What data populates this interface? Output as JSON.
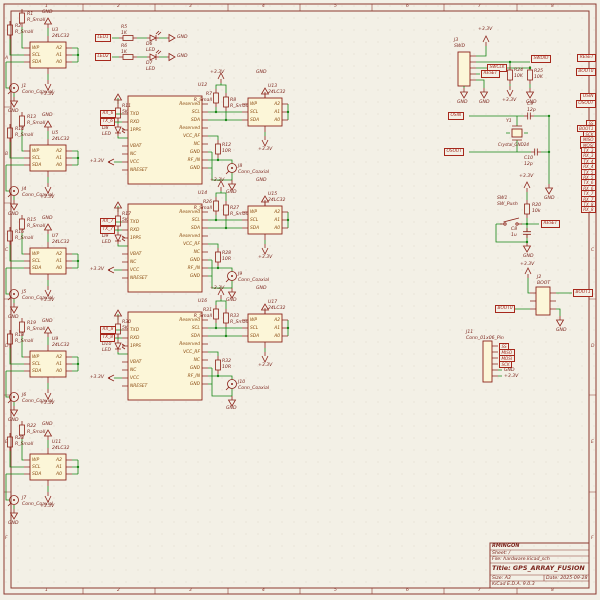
{
  "shared": {
    "gnd": "GND",
    "v33": "+3.3V"
  },
  "frame": {
    "cols": [
      "1",
      "2",
      "3",
      "4",
      "5",
      "6",
      "7",
      "8"
    ],
    "rows": [
      "A",
      "B",
      "C",
      "D",
      "E",
      "F"
    ]
  },
  "title_block": {
    "company": "RMINGON",
    "sheet": "Sheet: /",
    "file": "File: hardware.kicad_sch",
    "title": "Title: GPS_ARRAY_FUSION",
    "size": "Size: A3",
    "date": "Date: 2025-09-28",
    "tool": "KiCad E.D.A. 9.0.3"
  },
  "pins": {
    "ee_l": "WP\nSCL\nSDA",
    "ee_r": "A2\nA1\nA0",
    "gps_l": "TXD\nRXD\n1PPS\n\nVBAT\nNC\nVCC\nNRESET",
    "gps_r": "Reserved\nSCL\nSDA\nReserved\nVCC_RF\nNC\nGND\nRF_IN\nGND"
  },
  "eeproms": [
    {
      "u": "U3\n24LC32",
      "r1": "R1\nR_Small",
      "r2": "R2\nR_Small",
      "j": "J1\nConn_Coaxial"
    },
    {
      "u": "U5\n24LC32",
      "r1": "R13\nR_Small",
      "r2": "R14\nR_Small",
      "j": "J4\nConn_Coaxial"
    },
    {
      "u": "U7\n24LC32",
      "r1": "R15\nR_Small",
      "r2": "R16\nR_Small",
      "j": "J5\nConn_Coaxial"
    },
    {
      "u": "U9\n24LC32",
      "r1": "R19\nR_Small",
      "r2": "R18\nR_Small",
      "j": "J6\nConn_Coaxial"
    },
    {
      "u": "U11\n24LC32",
      "r1": "R22\nR_Small",
      "r2": "R23\nR_Small",
      "j": "J7\nConn_Coaxial"
    }
  ],
  "gps": [
    {
      "u": "U12",
      "r": "R11\n5K",
      "d": "D8\nLED",
      "rx": "RX_6",
      "tx": "TX_6",
      "pu1": "R7\nR_Small",
      "pu2": "R8\nR_Small",
      "rf": "R12\n10R",
      "j": "J8\nConn_Coaxial",
      "ee": "U13\n24LC32"
    },
    {
      "u": "U14",
      "r": "R17\n5K",
      "d": "D9\nLED",
      "rx": "RX_7",
      "tx": "TX_7",
      "pu1": "R26\nR_Small",
      "pu2": "R27\nR_Small",
      "rf": "R28\n10R",
      "j": "J9\nConn_Coaxial",
      "ee": "U15\n24LC32"
    },
    {
      "u": "U16",
      "r": "R30\n5K",
      "d": "D10\nLED",
      "rx": "RX_8",
      "tx": "TX_8",
      "pu1": "R31\nR_Small",
      "pu2": "R33\nR_Small",
      "rf": "R32\n10R",
      "j": "J10\nConn_Coaxial",
      "ee": "U17\n24LC32"
    }
  ],
  "leds": [
    {
      "lbl": "LED1",
      "r": "R5\n1K",
      "d": "D6\nLED"
    },
    {
      "lbl": "LED2",
      "r": "R6\n1K",
      "d": "D7\nLED"
    }
  ],
  "swd": {
    "u": "J3\nSWD",
    "dio": "SWDIO",
    "clk": "SWCLK",
    "rst": "RESET",
    "r1": "R24\n10K",
    "r2": "R25\n10K"
  },
  "xtal": {
    "in": "OSIN",
    "out": "OSOUT",
    "y": "Y1",
    "yv": "Crystal_GND24",
    "c1": "C9\n12p",
    "c2": "C10\n12p"
  },
  "sw": {
    "u": "SW1\nSW_Push",
    "r": "R20\n10k",
    "c": "C8\n1u",
    "rst": "RESET"
  },
  "boot": {
    "u": "J2\nBOOT",
    "b0": "BOOT0",
    "b1": "BOOT1"
  },
  "j11": {
    "u": "J11\nConn_01x06_Pin",
    "pins": [
      "SS",
      "MISO",
      "MOSI",
      "SCK"
    ]
  },
  "edge": {
    "rst": "RESET",
    "b0": "BOOT0",
    "in": "OSIN",
    "out": "OSOUT",
    "stack": [
      "SS",
      "BOOT1",
      "SCK",
      "MISO",
      "MOSI",
      "TX_3",
      "RX_3",
      "TX_4",
      "RX_4",
      "TX_5",
      "RX_5",
      "TX_6",
      "RX_6",
      "TX_7",
      "RX_7",
      "TX_8",
      "RX_8"
    ]
  }
}
